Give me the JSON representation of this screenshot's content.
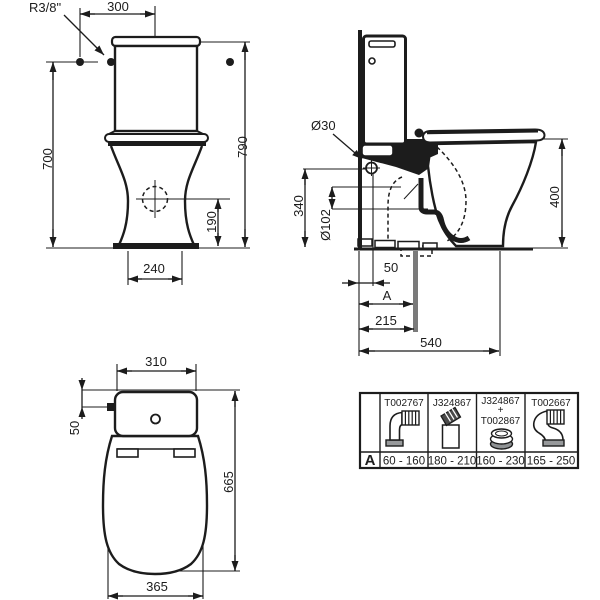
{
  "views": {
    "front": {
      "labels": {
        "supply": "R3/8\"",
        "width": "300",
        "height_supply": "700",
        "height_total": "790",
        "drain_height": "190",
        "base_width": "240"
      }
    },
    "side": {
      "labels": {
        "fixing_hole_dia": "Ø30",
        "fixing_hole_height": "340",
        "outlet_dia": "Ø102",
        "bowl_height": "400",
        "wall_offset": "50",
        "adjustable": "A",
        "outlet_distance": "215",
        "total_depth": "540"
      }
    },
    "top": {
      "labels": {
        "cistern_width": "310",
        "inlet_offset": "50",
        "overall_length": "665",
        "bowl_width": "365"
      }
    }
  },
  "table": {
    "row_label": "A",
    "columns": [
      {
        "part": "T002767",
        "range": "60 - 160",
        "icon": "elbow-connector"
      },
      {
        "part": "J324867",
        "range": "180 - 210",
        "icon": "straight-connector"
      },
      {
        "part": "J324867",
        "plus": "+",
        "part2": "T002867",
        "range": "160 - 230",
        "icon": "offset-ring-connector"
      },
      {
        "part": "T002667",
        "range": "165 - 250",
        "icon": "swan-neck-connector"
      }
    ]
  },
  "colors": {
    "ink": "#1c1c1c",
    "gray_pipe": "#7a7a7a",
    "pad_gray": "#97999b"
  }
}
